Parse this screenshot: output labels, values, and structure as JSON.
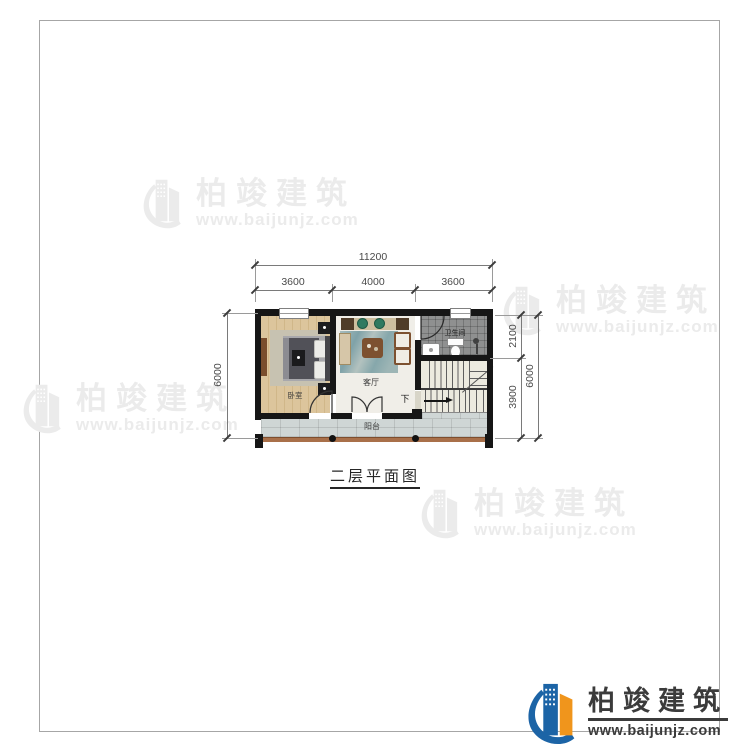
{
  "sheet": {
    "title": "二层平面图"
  },
  "watermark": {
    "brand": "柏竣建筑",
    "url": "www.baijunjz.com",
    "icon": "building-swoosh-logo"
  },
  "logo": {
    "brand": "柏竣建筑",
    "url": "www.baijunjz.com"
  },
  "plan": {
    "rooms": {
      "bedroom": "卧室",
      "living": "客厅",
      "bathroom": "卫生间",
      "balcony": "阳台",
      "stairs_down": "下"
    },
    "dimensions": {
      "top_total": "11200",
      "top_segments": [
        "3600",
        "4000",
        "3600"
      ],
      "left_total": "6000",
      "right_upper": "2100",
      "right_lower": "3900",
      "right_total": "6000"
    }
  }
}
